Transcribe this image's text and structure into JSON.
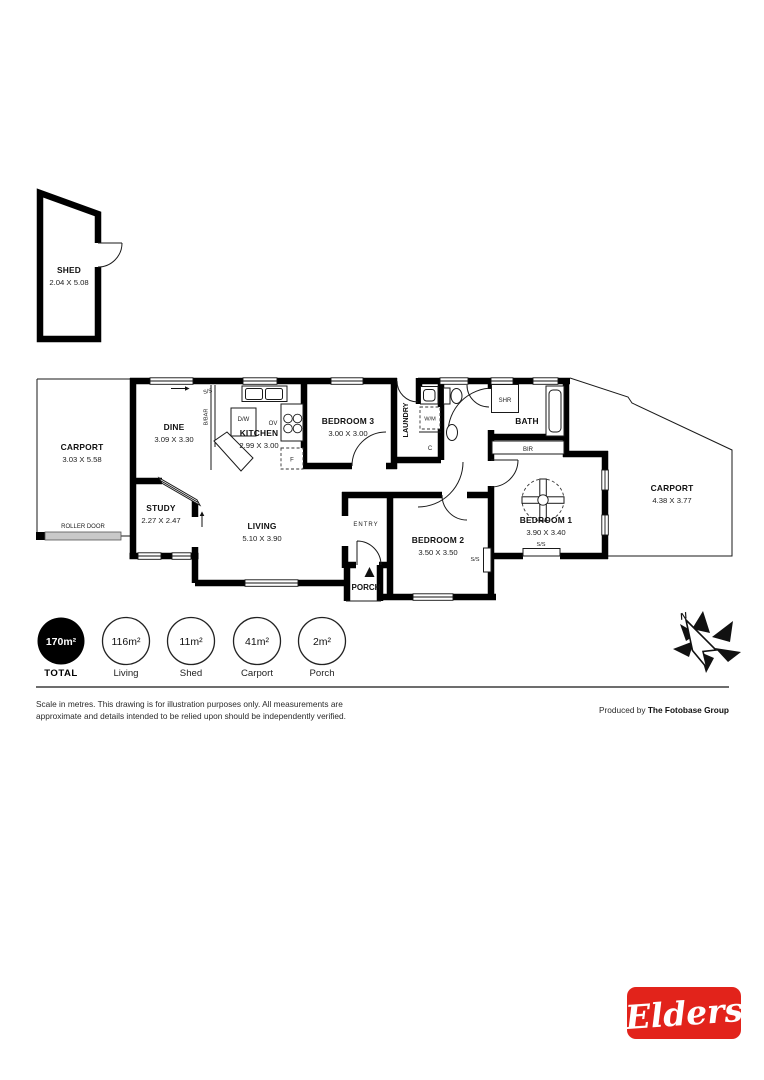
{
  "plan": {
    "shed": {
      "label": "SHED",
      "dims": "2.04 X 5.08"
    },
    "carport_left": {
      "label": "CARPORT",
      "dims": "3.03 X 5.58"
    },
    "roller_door": "ROLLER DOOR",
    "dine": {
      "label": "DINE",
      "dims": "3.09 X 3.30"
    },
    "kitchen": {
      "label": "KITCHEN",
      "dims": "2.99 X 3.00"
    },
    "study": {
      "label": "STUDY",
      "dims": "2.27 X 2.47"
    },
    "living": {
      "label": "LIVING",
      "dims": "5.10 X 3.90"
    },
    "bedroom3": {
      "label": "BEDROOM 3",
      "dims": "3.00 X 3.00"
    },
    "bedroom2": {
      "label": "BEDROOM 2",
      "dims": "3.50 X 3.50"
    },
    "bedroom1": {
      "label": "BEDROOM 1",
      "dims": "3.90 X 3.40"
    },
    "carport_right": {
      "label": "CARPORT",
      "dims": "4.38 X 3.77"
    },
    "bath": "BATH",
    "entry": "ENTRY",
    "porch": "PORCH",
    "laundry": "LAUNDRY",
    "fixtures": {
      "bbar": "B/BAR",
      "dw": "D/W",
      "ov": "OV",
      "fridge": "F",
      "ss_kitchen": "S/S",
      "wm": "W/M",
      "cupboard": "C",
      "shr": "SHR",
      "bir": "BIR",
      "ss_bed1": "S/S",
      "ss_bed2": "S/S"
    }
  },
  "legend": {
    "items": [
      {
        "value": "170m²",
        "label": "TOTAL",
        "filled": true
      },
      {
        "value": "116m²",
        "label": "Living",
        "filled": false
      },
      {
        "value": "11m²",
        "label": "Shed",
        "filled": false
      },
      {
        "value": "41m²",
        "label": "Carport",
        "filled": false
      },
      {
        "value": "2m²",
        "label": "Porch",
        "filled": false
      }
    ]
  },
  "compass": {
    "north": "N"
  },
  "footer": {
    "line1": "Scale in metres. This drawing is for illustration purposes only. All measurements are",
    "line2": "approximate and details intended to be relied upon should be independently verified.",
    "produced_prefix": "Produced by ",
    "produced_brand": "The Fotobase Group"
  },
  "brand": {
    "name": "Elders"
  },
  "colors": {
    "wall": "#000000",
    "brand_red": "#e2231b",
    "roller_door": "#c9c9c9"
  }
}
